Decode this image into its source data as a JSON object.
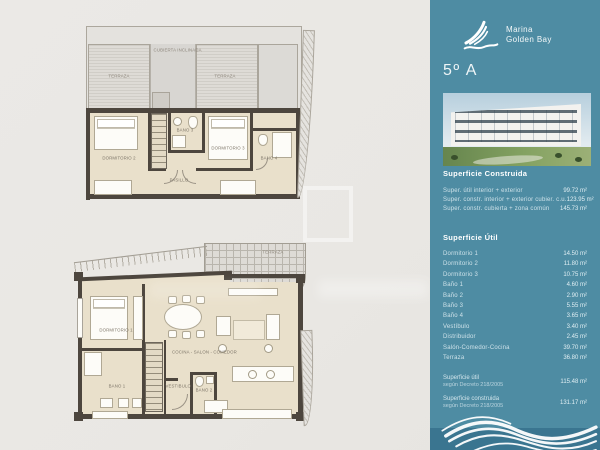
{
  "brand": {
    "name_line1": "Marina",
    "name_line2": "Golden Bay"
  },
  "sidebar": {
    "unit_title": "5º A",
    "construida": {
      "title": "Superficie Construida",
      "rows": [
        {
          "label": "Super. útil interior + exterior",
          "value": "99.72 m²"
        },
        {
          "label": "Super. constr. interior + exterior cubier. c.u.",
          "value": "123.95 m²"
        },
        {
          "label": "Super. constr. cubierta + zona común",
          "value": "145.73 m²"
        }
      ]
    },
    "util": {
      "title": "Superficie Útil",
      "rows": [
        {
          "label": "Dormitorio 1",
          "value": "14.50 m²"
        },
        {
          "label": "Dormitorio 2",
          "value": "11.80 m²"
        },
        {
          "label": "Dormitorio 3",
          "value": "10.75 m²"
        },
        {
          "label": "Baño 1",
          "value": "4.60 m²"
        },
        {
          "label": "Baño 2",
          "value": "2.90 m²"
        },
        {
          "label": "Baño 3",
          "value": "5.55 m²"
        },
        {
          "label": "Baño 4",
          "value": "3.65 m²"
        },
        {
          "label": "Vestíbulo",
          "value": "3.40 m²"
        },
        {
          "label": "Distribuidor",
          "value": "2.45 m²"
        },
        {
          "label": "Salón-Comedor-Cocina",
          "value": "39.70 m²"
        },
        {
          "label": "Terraza",
          "value": "36.80 m²"
        }
      ]
    },
    "totals": [
      {
        "line1": "Superficie útil",
        "line2": "según Decreto 218/2005",
        "value": "115.48 m²"
      },
      {
        "line1": "Superficie construida",
        "line2": "según Decreto 218/2005",
        "value": "131.17 m²"
      }
    ],
    "colors": {
      "panel": "#4e8ca3",
      "panel_band": "#3a7590",
      "text": "#ffffff"
    }
  },
  "plans": {
    "upper": {
      "labels": {
        "cubierta": "CUBIERTA INCLINADA",
        "terraza_left": "TERRAZA",
        "terraza_right": "TERRAZA",
        "dorm2": "DORMITORIO 2",
        "bano3": "BAÑO 3",
        "dorm3": "DORMITORIO 3",
        "pasillo": "PASILLO",
        "bano4": "BAÑO 4"
      }
    },
    "lower": {
      "labels": {
        "terraza": "TERRAZA",
        "dorm1": "DORMITORIO 1",
        "cocina": "COCINA - SALÓN - COMEDOR",
        "bano1": "BAÑO 1",
        "vestibulo": "VESTÍBULO",
        "bano2": "BAÑO 2"
      }
    }
  }
}
